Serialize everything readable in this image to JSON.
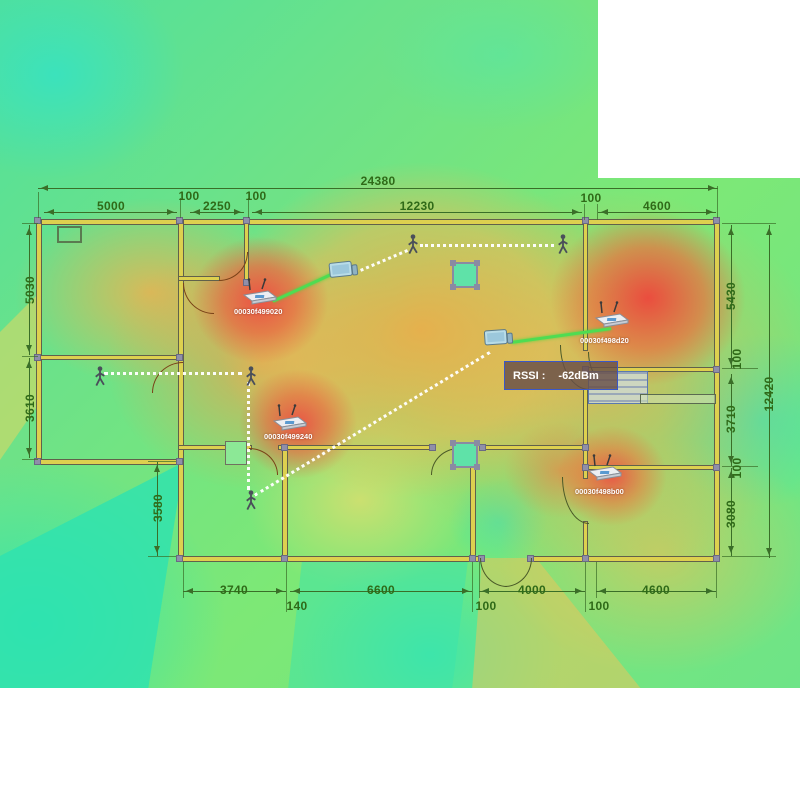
{
  "heat_palette": {
    "hot": "#ee4c42",
    "warm": "#f59b50",
    "mid": "#f0d860",
    "cool": "#8ce87a",
    "cold": "#3ce2b2"
  },
  "tooltip": {
    "label": "RSSI :",
    "value": "-62dBm"
  },
  "access_points": [
    {
      "id": "00030f499020"
    },
    {
      "id": "00030f499240"
    },
    {
      "id": "00030f498d20"
    },
    {
      "id": "00030f498b00"
    }
  ],
  "dims": {
    "total_width": "24380",
    "left_room": "5000",
    "wall_a": "100",
    "vestibule": "2250",
    "hall": "12230",
    "right_room": "4600",
    "left_h1": "5030",
    "left_h2": "3610",
    "left_h3": "3580",
    "right_h1": "5430",
    "right_h2": "3710",
    "right_h3": "3080",
    "total_height": "12420",
    "bottom_1": "3740",
    "bottom_wall": "140",
    "bottom_2": "6600",
    "bottom_3": "4000",
    "bottom_4": "4600"
  }
}
